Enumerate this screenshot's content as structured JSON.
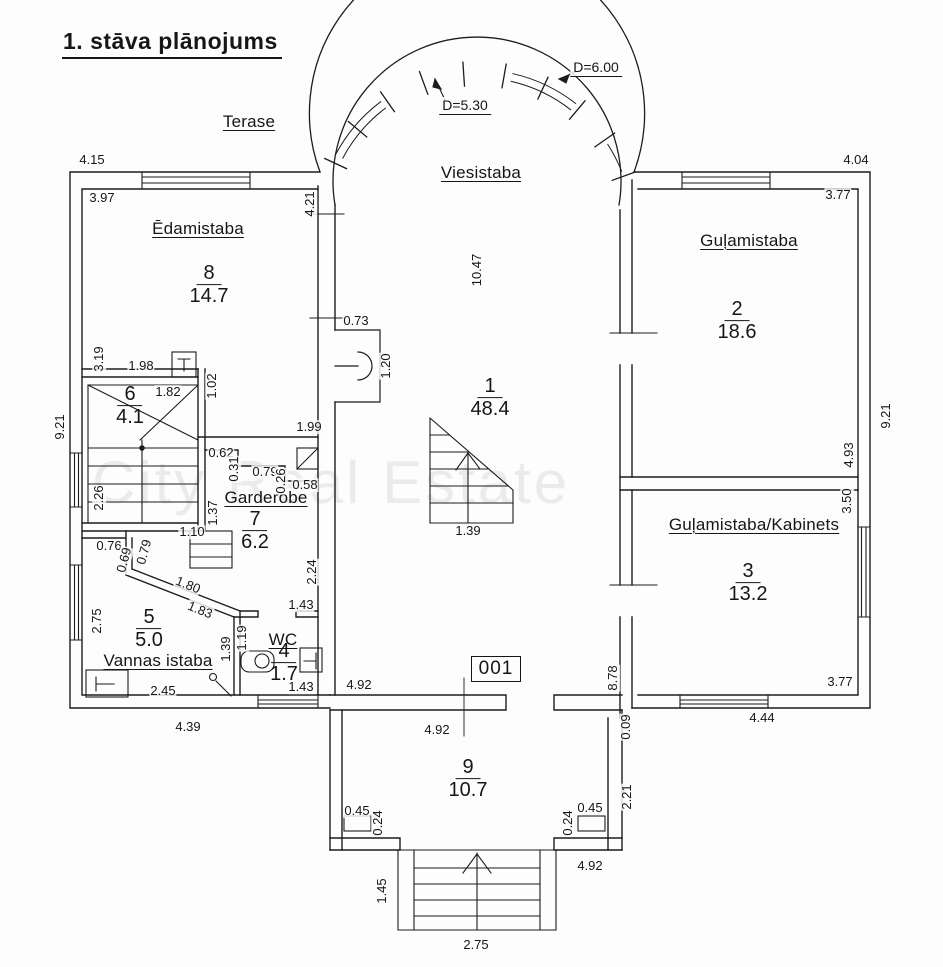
{
  "title": "1. stāva plānojums",
  "watermark": "City Real Estate",
  "unit_number": "001",
  "outdoor": {
    "terrace_label": "Terase"
  },
  "arch": {
    "outer_diameter": "D=6.00",
    "inner_diameter": "D=5.30"
  },
  "line_color": "#1c1c1c",
  "rooms": [
    {
      "num": "1",
      "name": "Viesistaba",
      "area": "48.4",
      "nx": 481,
      "ny": 173,
      "fx": 490,
      "fy": 398
    },
    {
      "num": "2",
      "name": "Guļamistaba",
      "area": "18.6",
      "nx": 749,
      "ny": 241,
      "fx": 737,
      "fy": 321
    },
    {
      "num": "3",
      "name": "Guļamistaba/Kabinets",
      "area": "13.2",
      "nx": 754,
      "ny": 525,
      "fx": 748,
      "fy": 583
    },
    {
      "num": "4",
      "name": "WC",
      "area": "1.7",
      "nx": 283,
      "ny": 640,
      "fx": 284,
      "fy": 663
    },
    {
      "num": "5",
      "name": "Vannas istaba",
      "area": "5.0",
      "nx": 158,
      "ny": 661,
      "fx": 149,
      "fy": 629
    },
    {
      "num": "6",
      "name": "",
      "area": "4.1",
      "fx": 130,
      "fy": 406
    },
    {
      "num": "7",
      "name": "Garderobe",
      "area": "6.2",
      "nx": 266,
      "ny": 498,
      "fx": 255,
      "fy": 531
    },
    {
      "num": "8",
      "name": "Ēdamistaba",
      "area": "14.7",
      "nx": 198,
      "ny": 229,
      "fx": 209,
      "fy": 285
    },
    {
      "num": "9",
      "name": "",
      "area": "10.7",
      "fx": 468,
      "fy": 779
    }
  ],
  "dimensions": [
    {
      "t": "4.15",
      "x": 92,
      "y": 160,
      "r": 0
    },
    {
      "t": "3.97",
      "x": 102,
      "y": 198,
      "r": 0
    },
    {
      "t": "4.21",
      "x": 310,
      "y": 204,
      "r": -90
    },
    {
      "t": "4.04",
      "x": 856,
      "y": 160,
      "r": 0
    },
    {
      "t": "3.77",
      "x": 838,
      "y": 195,
      "r": 0
    },
    {
      "t": "9.21",
      "x": 60,
      "y": 427,
      "r": -90
    },
    {
      "t": "3.19",
      "x": 99,
      "y": 359,
      "r": -90
    },
    {
      "t": "1.98",
      "x": 141,
      "y": 366,
      "r": 0
    },
    {
      "t": "1.82",
      "x": 168,
      "y": 392,
      "r": 0
    },
    {
      "t": "1.02",
      "x": 212,
      "y": 386,
      "r": -90
    },
    {
      "t": "1.99",
      "x": 309,
      "y": 427,
      "r": 0
    },
    {
      "t": "0.73",
      "x": 356,
      "y": 321,
      "r": 0
    },
    {
      "t": "1.20",
      "x": 386,
      "y": 366,
      "r": -90
    },
    {
      "t": "10.47",
      "x": 477,
      "y": 270,
      "r": -90
    },
    {
      "t": "2.26",
      "x": 99,
      "y": 498,
      "r": -90
    },
    {
      "t": "1.10",
      "x": 192,
      "y": 532,
      "r": 0
    },
    {
      "t": "0.62",
      "x": 221,
      "y": 453,
      "r": 0
    },
    {
      "t": "0.31",
      "x": 234,
      "y": 469,
      "r": -90
    },
    {
      "t": "0.79",
      "x": 265,
      "y": 472,
      "r": 0
    },
    {
      "t": "0.26",
      "x": 281,
      "y": 481,
      "r": -90
    },
    {
      "t": "0.58",
      "x": 305,
      "y": 485,
      "r": 0
    },
    {
      "t": "1.37",
      "x": 213,
      "y": 513,
      "r": -90
    },
    {
      "t": "2.24",
      "x": 312,
      "y": 572,
      "r": -90
    },
    {
      "t": "1.43",
      "x": 301,
      "y": 605,
      "r": 0
    },
    {
      "t": "0.76",
      "x": 109,
      "y": 546,
      "r": 0
    },
    {
      "t": "0.69",
      "x": 124,
      "y": 560,
      "r": -75
    },
    {
      "t": "0.79",
      "x": 144,
      "y": 552,
      "r": -75
    },
    {
      "t": "1.80",
      "x": 188,
      "y": 585,
      "r": 22
    },
    {
      "t": "1.83",
      "x": 200,
      "y": 610,
      "r": 22
    },
    {
      "t": "2.75",
      "x": 97,
      "y": 621,
      "r": -90
    },
    {
      "t": "1.39",
      "x": 226,
      "y": 649,
      "r": -90
    },
    {
      "t": "1.19",
      "x": 242,
      "y": 638,
      "r": -90
    },
    {
      "t": "2.45",
      "x": 163,
      "y": 691,
      "r": 0
    },
    {
      "t": "4.39",
      "x": 188,
      "y": 727,
      "r": 0
    },
    {
      "t": "1.43",
      "x": 301,
      "y": 687,
      "r": 0
    },
    {
      "t": "1.39",
      "x": 468,
      "y": 531,
      "r": 0
    },
    {
      "t": "4.92",
      "x": 359,
      "y": 685,
      "r": 0
    },
    {
      "t": "8.78",
      "x": 613,
      "y": 678,
      "r": -90
    },
    {
      "t": "0.09",
      "x": 626,
      "y": 727,
      "r": -90
    },
    {
      "t": "4.92",
      "x": 437,
      "y": 730,
      "r": 0
    },
    {
      "t": "9.21",
      "x": 886,
      "y": 416,
      "r": -90
    },
    {
      "t": "4.93",
      "x": 849,
      "y": 455,
      "r": -90
    },
    {
      "t": "3.50",
      "x": 847,
      "y": 501,
      "r": -90
    },
    {
      "t": "3.77",
      "x": 840,
      "y": 682,
      "r": 0
    },
    {
      "t": "4.44",
      "x": 762,
      "y": 718,
      "r": 0
    },
    {
      "t": "2.21",
      "x": 627,
      "y": 797,
      "r": -90
    },
    {
      "t": "0.45",
      "x": 357,
      "y": 811,
      "r": 0
    },
    {
      "t": "0.24",
      "x": 378,
      "y": 823,
      "r": -90
    },
    {
      "t": "0.45",
      "x": 590,
      "y": 808,
      "r": 0
    },
    {
      "t": "0.24",
      "x": 568,
      "y": 823,
      "r": -90
    },
    {
      "t": "4.92",
      "x": 590,
      "y": 866,
      "r": 0
    },
    {
      "t": "1.45",
      "x": 382,
      "y": 891,
      "r": -90
    },
    {
      "t": "2.75",
      "x": 476,
      "y": 945,
      "r": 0
    }
  ]
}
